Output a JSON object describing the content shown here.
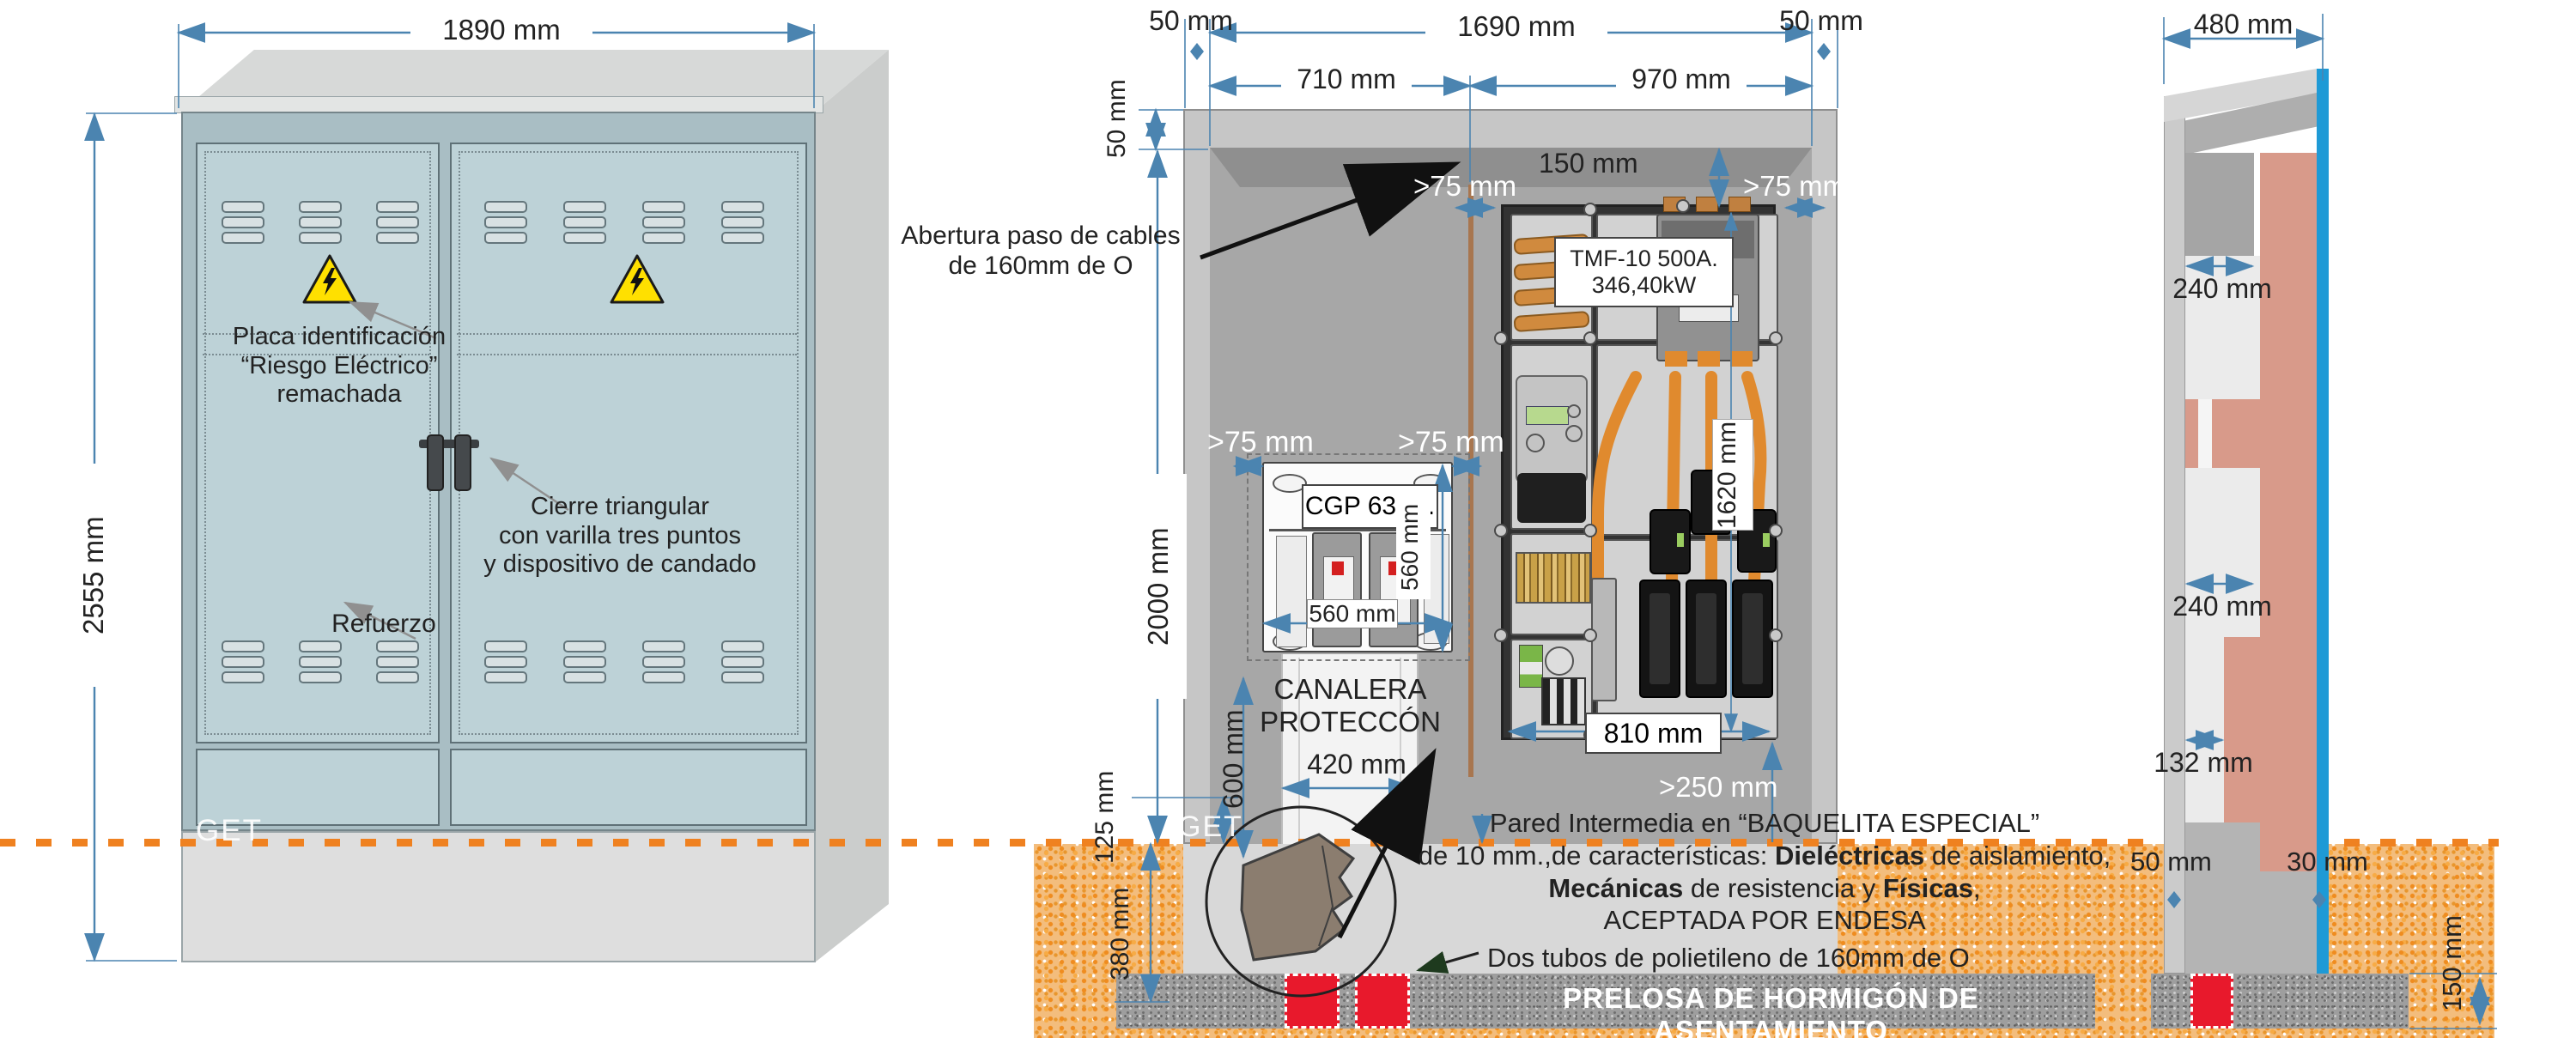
{
  "left_view": {
    "dim_width": "1890 mm",
    "dim_height": "2555 mm",
    "label_placa": "Placa identificación\n“Riesgo Eléctrico”\nremachada",
    "label_cierre": "Cierre triangular\ncon varilla tres puntos\ny dispositivo de candado",
    "label_refuerzo": "Refuerzo",
    "label_get": "GET"
  },
  "front_view": {
    "dim_50_left": "50 mm",
    "dim_1690": "1690 mm",
    "dim_50_right": "50 mm",
    "dim_710": "710 mm",
    "dim_970": "970 mm",
    "dim_50_top_wall": "50 mm",
    "dim_2000": "2000 mm",
    "dim_150": "150 mm",
    "gt75_top_left": ">75 mm",
    "gt75_top_right": ">75 mm",
    "label_abertura": "Abertura paso de cables\nde 160mm de O",
    "label_get": "GET",
    "dim_125": "125 mm",
    "dim_380": "380 mm",
    "dim_gt250": ">250 mm"
  },
  "cgp": {
    "title": "CGP 630A.",
    "gt75_left": ">75 mm",
    "gt75_right": ">75 mm",
    "dim_width": "560 mm",
    "dim_height": "560 mm"
  },
  "tmf": {
    "label": "TMF-10 500A.\n346,40kW",
    "dim_height": "1620 mm",
    "dim_width": "810 mm"
  },
  "canalera": {
    "title": "CANALERA\nPROTECCÓN",
    "dim_width": "420 mm",
    "dim_height": "600 mm"
  },
  "foundation": {
    "pared_l1": "Pared Intermedia en “BAQUELITA ESPECIAL”",
    "pared_l2a": "de 10 mm.,de características: ",
    "pared_l2b": "Dieléctricas",
    "pared_l2c": " de aislamiento,",
    "pared_l3a": "Mecánicas",
    "pared_l3b": " de resistencia y ",
    "pared_l3c": "Físicas",
    "pared_l3d": ",",
    "pared_l4": "ACEPTADA POR ENDESA",
    "label_tubos": "Dos tubos de polietileno de 160mm de O",
    "label_prelosa": "PRELOSA DE HORMIGÓN DE ASENTAMIENTO"
  },
  "side_view": {
    "dim_480": "480 mm",
    "dim_240_top": "240 mm",
    "dim_240_mid": "240 mm",
    "dim_132": "132 mm",
    "dim_50": "50 mm",
    "dim_30": "30 mm",
    "dim_150": "150 mm"
  },
  "colors": {
    "dimension": "#4b84b0",
    "ground_dash": "#ef8120",
    "soil": "#f3bd7d",
    "salmon_wall": "#d89a8a",
    "cable_orange": "#e08a2e",
    "tube_red": "#e8192c",
    "door_blue": "#bdd2d7",
    "warning_yellow": "#ffe000",
    "water_blue": "#1e9ad6"
  }
}
